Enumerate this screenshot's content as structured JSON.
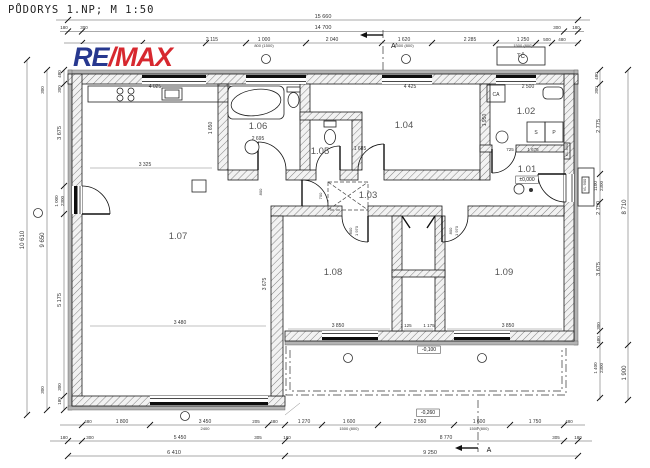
{
  "title": "PŮDORYS 1.NP; M 1:50",
  "logo": {
    "re": "RE",
    "slash": "/",
    "max": "MAX",
    "re_color": "#27388f",
    "slash_color": "#d7282f",
    "max_color": "#d7282f"
  },
  "rooms": [
    {
      "t": "1.01",
      "x": 527,
      "y": 172
    },
    {
      "t": "1.02",
      "x": 526,
      "y": 114
    },
    {
      "t": "1.03",
      "x": 368,
      "y": 198
    },
    {
      "t": "1.04",
      "x": 404,
      "y": 128
    },
    {
      "t": "1.05",
      "x": 320,
      "y": 154
    },
    {
      "t": "1.06",
      "x": 258,
      "y": 129
    },
    {
      "t": "1.07",
      "x": 178,
      "y": 239
    },
    {
      "t": "1.08",
      "x": 333,
      "y": 275
    },
    {
      "t": "1.09",
      "x": 504,
      "y": 275
    }
  ],
  "levels": [
    {
      "t": "±0,000",
      "x": 527,
      "y": 181,
      "s": 5,
      "box": true
    },
    {
      "t": "-0,100",
      "x": 429,
      "y": 351,
      "s": 5,
      "box": true
    },
    {
      "t": "-0,260",
      "x": 428,
      "y": 414,
      "s": 5,
      "box": true
    }
  ],
  "equipment": [
    {
      "t": "TČ",
      "x": 521,
      "y": 58,
      "s": 6
    },
    {
      "t": "CA",
      "x": 496,
      "y": 96,
      "s": 5
    },
    {
      "t": "S",
      "x": 536,
      "y": 134,
      "s": 5
    },
    {
      "t": "P",
      "x": 554,
      "y": 134,
      "s": 5
    }
  ],
  "door_tags": [
    {
      "t": "KL 800",
      "x": 568,
      "y": 150,
      "r": -90,
      "s": 4
    },
    {
      "t": "VL 900",
      "x": 586,
      "y": 185,
      "r": -90,
      "s": 4
    }
  ],
  "section_marks": [
    {
      "t": "A'",
      "x": 394,
      "y": 48,
      "s": 7
    },
    {
      "t": "A",
      "x": 489,
      "y": 452,
      "s": 7
    }
  ],
  "dims": {
    "top": [
      {
        "t": "15 660",
        "x": 323,
        "y": 18,
        "s": 5.5
      },
      {
        "t": "180",
        "x": 64,
        "y": 29,
        "s": 4.5
      },
      {
        "t": "300",
        "x": 84,
        "y": 29,
        "s": 4.5
      },
      {
        "t": "14 700",
        "x": 323,
        "y": 29,
        "s": 5.5
      },
      {
        "t": "300",
        "x": 557,
        "y": 29,
        "s": 4.5
      },
      {
        "t": "180",
        "x": 576,
        "y": 29,
        "s": 4.5
      },
      {
        "t": "2 115",
        "x": 212,
        "y": 41,
        "s": 5
      },
      {
        "t": "1 000",
        "x": 264,
        "y": 41,
        "s": 5
      },
      {
        "t": "800 (1500)",
        "x": 264,
        "y": 47,
        "s": 4
      },
      {
        "t": "2 040",
        "x": 332,
        "y": 41,
        "s": 5
      },
      {
        "t": "1 620",
        "x": 404,
        "y": 41,
        "s": 5
      },
      {
        "t": "1500 (800)",
        "x": 404,
        "y": 47,
        "s": 4
      },
      {
        "t": "2 285",
        "x": 470,
        "y": 41,
        "s": 5
      },
      {
        "t": "1 250",
        "x": 523,
        "y": 41,
        "s": 5
      },
      {
        "t": "1500 (800)",
        "x": 523,
        "y": 47,
        "s": 4
      },
      {
        "t": "500",
        "x": 547,
        "y": 41,
        "s": 4.5
      },
      {
        "t": "480",
        "x": 562,
        "y": 41,
        "s": 4.5
      }
    ],
    "bottom": [
      {
        "t": "480",
        "x": 88,
        "y": 423,
        "s": 4.5
      },
      {
        "t": "1 800",
        "x": 122,
        "y": 423,
        "s": 5
      },
      {
        "t": "3 450",
        "x": 205,
        "y": 423,
        "s": 5
      },
      {
        "t": "2400",
        "x": 205,
        "y": 430,
        "s": 4
      },
      {
        "t": "205",
        "x": 256,
        "y": 423,
        "s": 4.5
      },
      {
        "t": "480",
        "x": 274,
        "y": 423,
        "s": 4.5
      },
      {
        "t": "1 270",
        "x": 304,
        "y": 423,
        "s": 5
      },
      {
        "t": "1 600",
        "x": 349,
        "y": 423,
        "s": 5
      },
      {
        "t": "1500 (800)",
        "x": 349,
        "y": 430,
        "s": 4
      },
      {
        "t": "2 550",
        "x": 420,
        "y": 423,
        "s": 5
      },
      {
        "t": "1 600",
        "x": 479,
        "y": 423,
        "s": 5
      },
      {
        "t": "1500 (800)",
        "x": 479,
        "y": 430,
        "s": 4
      },
      {
        "t": "1 750",
        "x": 535,
        "y": 423,
        "s": 5
      },
      {
        "t": "480",
        "x": 569,
        "y": 423,
        "s": 4.5
      },
      {
        "t": "180",
        "x": 64,
        "y": 439,
        "s": 4.5
      },
      {
        "t": "300",
        "x": 90,
        "y": 439,
        "s": 4.5
      },
      {
        "t": "5 450",
        "x": 180,
        "y": 439,
        "s": 5
      },
      {
        "t": "305",
        "x": 258,
        "y": 439,
        "s": 4.5
      },
      {
        "t": "180",
        "x": 287,
        "y": 439,
        "s": 4.5
      },
      {
        "t": "8 770",
        "x": 446,
        "y": 439,
        "s": 5
      },
      {
        "t": "305",
        "x": 556,
        "y": 439,
        "s": 4.5
      },
      {
        "t": "180",
        "x": 578,
        "y": 439,
        "s": 4.5
      },
      {
        "t": "6 410",
        "x": 174,
        "y": 454,
        "s": 5.5
      },
      {
        "t": "9 250",
        "x": 430,
        "y": 454,
        "s": 5.5
      }
    ],
    "left": [
      {
        "t": "10 610",
        "x": 24,
        "y": 240,
        "r": -90,
        "s": 6
      },
      {
        "t": "9 650",
        "x": 44,
        "y": 240,
        "r": -90,
        "s": 6
      },
      {
        "t": "300",
        "x": 44,
        "y": 90,
        "r": -90,
        "s": 4.5
      },
      {
        "t": "300",
        "x": 44,
        "y": 390,
        "r": -90,
        "s": 4.5
      },
      {
        "t": "480",
        "x": 61,
        "y": 74,
        "r": -90,
        "s": 4.5
      },
      {
        "t": "300",
        "x": 61,
        "y": 89,
        "r": -90,
        "s": 4.5
      },
      {
        "t": "3 675",
        "x": 61,
        "y": 133,
        "r": -90,
        "s": 5.5
      },
      {
        "t": "1 000",
        "x": 58,
        "y": 201,
        "r": -90,
        "s": 4.5
      },
      {
        "t": "2300",
        "x": 64,
        "y": 201,
        "r": -90,
        "s": 4.5
      },
      {
        "t": "5 175",
        "x": 61,
        "y": 300,
        "r": -90,
        "s": 5.5
      },
      {
        "t": "300",
        "x": 61,
        "y": 387,
        "r": -90,
        "s": 4.5
      },
      {
        "t": "180",
        "x": 61,
        "y": 401,
        "r": -90,
        "s": 4.5
      }
    ],
    "right": [
      {
        "t": "480",
        "x": 598,
        "y": 76,
        "r": -90,
        "s": 4.5
      },
      {
        "t": "300",
        "x": 598,
        "y": 90,
        "r": -90,
        "s": 4.5
      },
      {
        "t": "2 775",
        "x": 600,
        "y": 126,
        "r": -90,
        "s": 5.5
      },
      {
        "t": "1100",
        "x": 597,
        "y": 186,
        "r": -90,
        "s": 4.5
      },
      {
        "t": "2300",
        "x": 603,
        "y": 186,
        "r": -90,
        "s": 4.5
      },
      {
        "t": "2 750",
        "x": 600,
        "y": 208,
        "r": -90,
        "s": 5.5
      },
      {
        "t": "3 675",
        "x": 600,
        "y": 269,
        "r": -90,
        "s": 5.5
      },
      {
        "t": "300",
        "x": 600,
        "y": 326,
        "r": -90,
        "s": 4.5
      },
      {
        "t": "480",
        "x": 600,
        "y": 340,
        "r": -90,
        "s": 4.5
      },
      {
        "t": "1 400",
        "x": 597,
        "y": 368,
        "r": -90,
        "s": 4.5
      },
      {
        "t": "2300",
        "x": 603,
        "y": 368,
        "r": -90,
        "s": 4.5
      },
      {
        "t": "8 710",
        "x": 626,
        "y": 207,
        "r": -90,
        "s": 6
      },
      {
        "t": "1 900",
        "x": 626,
        "y": 373,
        "r": -90,
        "s": 6
      }
    ],
    "interior": [
      {
        "t": "4 025",
        "x": 155,
        "y": 88,
        "s": 5
      },
      {
        "t": "1 650",
        "x": 212,
        "y": 128,
        "r": -90,
        "s": 5
      },
      {
        "t": "3 325",
        "x": 145,
        "y": 166,
        "s": 5
      },
      {
        "t": "2 695",
        "x": 258,
        "y": 140,
        "s": 5
      },
      {
        "t": "4 425",
        "x": 410,
        "y": 88,
        "s": 5
      },
      {
        "t": "1 685",
        "x": 360,
        "y": 150,
        "s": 5
      },
      {
        "t": "2 500",
        "x": 528,
        "y": 88,
        "s": 5
      },
      {
        "t": "1 950",
        "x": 486,
        "y": 120,
        "r": -90,
        "s": 5
      },
      {
        "t": "725",
        "x": 510,
        "y": 151,
        "s": 4.5
      },
      {
        "t": "1 675",
        "x": 533,
        "y": 151,
        "s": 4.5
      },
      {
        "t": "3 480",
        "x": 180,
        "y": 324,
        "s": 5
      },
      {
        "t": "3 675",
        "x": 266,
        "y": 284,
        "r": -90,
        "s": 5
      },
      {
        "t": "3 850",
        "x": 338,
        "y": 327,
        "s": 5
      },
      {
        "t": "1 125",
        "x": 406,
        "y": 327,
        "s": 4.5
      },
      {
        "t": "1 175",
        "x": 429,
        "y": 327,
        "s": 4.5
      },
      {
        "t": "3 850",
        "x": 508,
        "y": 327,
        "s": 5
      },
      {
        "t": "800",
        "x": 352,
        "y": 231,
        "r": -90,
        "s": 4
      },
      {
        "t": "1 970",
        "x": 358,
        "y": 231,
        "r": -90,
        "s": 4
      },
      {
        "t": "800",
        "x": 452,
        "y": 231,
        "r": -90,
        "s": 4
      },
      {
        "t": "1 970",
        "x": 458,
        "y": 231,
        "r": -90,
        "s": 4
      },
      {
        "t": "700",
        "x": 322,
        "y": 196,
        "r": -90,
        "s": 4
      },
      {
        "t": "800",
        "x": 262,
        "y": 192,
        "r": -90,
        "s": 4
      }
    ]
  }
}
